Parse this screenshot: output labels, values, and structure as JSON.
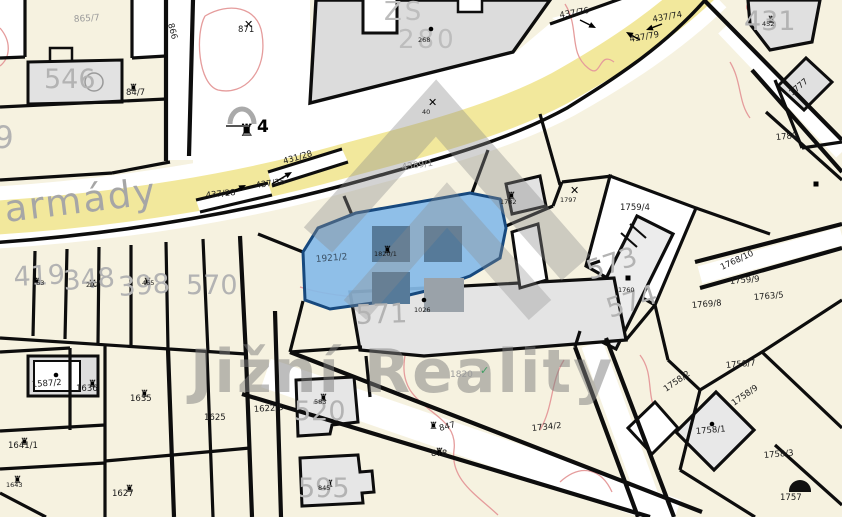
{
  "map": {
    "street": "armády",
    "watermark": "Jižní Reality",
    "school": {
      "abbr": "ZŠ",
      "number": "280"
    },
    "highlighted_parcel": {
      "number": "1921/2",
      "building_number": "1820/1",
      "fill": "#85bbe8",
      "border": "#17497e"
    },
    "colors": {
      "parcel_cream": "#f6f2e0",
      "road_yellow": "#f2e89c",
      "building_gray": "#dcdcdc",
      "highlight_blue": "#85bbe8",
      "highlight_building": "#567a99",
      "boundary_black": "#0d0d0d",
      "contour_red": "#e59c9c",
      "watermark_gray": "#7d7d7d"
    },
    "labels": [
      {
        "text": "865/7",
        "x": 74,
        "y": 22,
        "rot": -4,
        "cls": "sg"
      },
      {
        "text": "546",
        "x": 44,
        "y": 88,
        "rot": 0,
        "cls": "bg"
      },
      {
        "text": "84/7",
        "x": 126,
        "y": 95,
        "rot": 0,
        "cls": "sm"
      },
      {
        "text": "871",
        "x": 238,
        "y": 32,
        "rot": 0,
        "cls": "sm"
      },
      {
        "text": "866",
        "x": 168,
        "y": 24,
        "rot": 75,
        "cls": "sm"
      },
      {
        "text": "9",
        "x": -6,
        "y": 148,
        "rot": 0,
        "cls": "bg2"
      },
      {
        "text": "419",
        "x": 14,
        "y": 286,
        "rot": -3,
        "cls": "bg"
      },
      {
        "text": "348",
        "x": 64,
        "y": 290,
        "rot": -4,
        "cls": "bg"
      },
      {
        "text": "398",
        "x": 119,
        "y": 296,
        "rot": -4,
        "cls": "bg"
      },
      {
        "text": "570",
        "x": 186,
        "y": 294,
        "rot": 0,
        "cls": "bg"
      },
      {
        "text": "163",
        "x": 32,
        "y": 285,
        "rot": 0,
        "cls": "t6"
      },
      {
        "text": "292",
        "x": 86,
        "y": 287,
        "rot": 0,
        "cls": "t6"
      },
      {
        "text": "465",
        "x": 142,
        "y": 285,
        "rot": 0,
        "cls": "t6"
      },
      {
        "text": "268",
        "x": 418,
        "y": 42,
        "rot": 0,
        "cls": "t6"
      },
      {
        "text": "40",
        "x": 422,
        "y": 114,
        "rot": 0,
        "cls": "t6"
      },
      {
        "text": "4389/1",
        "x": 402,
        "y": 170,
        "rot": -8,
        "cls": "sg"
      },
      {
        "text": "431/28",
        "x": 284,
        "y": 164,
        "rot": -16,
        "cls": "sm"
      },
      {
        "text": "437/35",
        "x": 256,
        "y": 188,
        "rot": -8,
        "cls": "sm"
      },
      {
        "text": "437/28",
        "x": 206,
        "y": 198,
        "rot": -6,
        "cls": "sm"
      },
      {
        "text": "437/76",
        "x": 560,
        "y": 18,
        "rot": -10,
        "cls": "sm"
      },
      {
        "text": "437/74",
        "x": 653,
        "y": 22,
        "rot": -10,
        "cls": "sm"
      },
      {
        "text": "437/79",
        "x": 630,
        "y": 42,
        "rot": -10,
        "cls": "sm"
      },
      {
        "text": "431",
        "x": 744,
        "y": 30,
        "rot": 0,
        "cls": "bg"
      },
      {
        "text": "452",
        "x": 762,
        "y": 26,
        "rot": 0,
        "cls": "t6"
      },
      {
        "text": "1777",
        "x": 792,
        "y": 96,
        "rot": -40,
        "cls": "sm"
      },
      {
        "text": "1780",
        "x": 776,
        "y": 140,
        "rot": -5,
        "cls": "sm"
      },
      {
        "text": "571",
        "x": 356,
        "y": 324,
        "rot": -2,
        "cls": "bg"
      },
      {
        "text": "1026",
        "x": 414,
        "y": 312,
        "rot": 0,
        "cls": "t6"
      },
      {
        "text": "1782",
        "x": 500,
        "y": 204,
        "rot": 0,
        "cls": "t6"
      },
      {
        "text": "1797",
        "x": 560,
        "y": 202,
        "rot": 0,
        "cls": "t6"
      },
      {
        "text": "1759/4",
        "x": 620,
        "y": 210,
        "rot": 0,
        "cls": "sm"
      },
      {
        "text": "573",
        "x": 590,
        "y": 280,
        "rot": -18,
        "cls": "bg"
      },
      {
        "text": "574",
        "x": 610,
        "y": 318,
        "rot": -18,
        "cls": "bg"
      },
      {
        "text": "1760",
        "x": 618,
        "y": 292,
        "rot": 0,
        "cls": "t6"
      },
      {
        "text": "1768/10",
        "x": 722,
        "y": 270,
        "rot": -25,
        "cls": "sm"
      },
      {
        "text": "1759/9",
        "x": 730,
        "y": 284,
        "rot": -5,
        "cls": "sm"
      },
      {
        "text": "1763/5",
        "x": 754,
        "y": 300,
        "rot": -5,
        "cls": "sm"
      },
      {
        "text": "1769/8",
        "x": 692,
        "y": 308,
        "rot": -5,
        "cls": "sm"
      },
      {
        "text": "1758/7",
        "x": 726,
        "y": 368,
        "rot": -5,
        "cls": "sm"
      },
      {
        "text": "1758/2",
        "x": 666,
        "y": 392,
        "rot": -35,
        "cls": "sm"
      },
      {
        "text": "1758/9",
        "x": 734,
        "y": 406,
        "rot": -35,
        "cls": "sm"
      },
      {
        "text": "1758/1",
        "x": 696,
        "y": 434,
        "rot": -5,
        "cls": "sm"
      },
      {
        "text": "1758/3",
        "x": 764,
        "y": 458,
        "rot": -5,
        "cls": "sm"
      },
      {
        "text": "1757",
        "x": 780,
        "y": 500,
        "rot": 0,
        "cls": "sm"
      },
      {
        "text": "1820",
        "x": 450,
        "y": 377,
        "rot": 0,
        "cls": "sg"
      },
      {
        "text": "1734/2",
        "x": 532,
        "y": 431,
        "rot": -6,
        "cls": "sm"
      },
      {
        "text": "847",
        "x": 440,
        "y": 431,
        "rot": -15,
        "cls": "sm"
      },
      {
        "text": "878",
        "x": 431,
        "y": 456,
        "rot": 0,
        "cls": "sm"
      },
      {
        "text": "520",
        "x": 294,
        "y": 420,
        "rot": 0,
        "cls": "bg"
      },
      {
        "text": "583",
        "x": 314,
        "y": 404,
        "rot": 0,
        "cls": "t6"
      },
      {
        "text": "595",
        "x": 298,
        "y": 497,
        "rot": 0,
        "cls": "bg"
      },
      {
        "text": "845",
        "x": 318,
        "y": 490,
        "rot": 0,
        "cls": "t6"
      },
      {
        "text": "1587/2",
        "x": 32,
        "y": 387,
        "rot": -4,
        "cls": "sm"
      },
      {
        "text": "1636",
        "x": 76,
        "y": 391,
        "rot": 0,
        "cls": "sm"
      },
      {
        "text": "1635",
        "x": 130,
        "y": 401,
        "rot": 0,
        "cls": "sm"
      },
      {
        "text": "1625",
        "x": 204,
        "y": 420,
        "rot": 0,
        "cls": "sm"
      },
      {
        "text": "1641/1",
        "x": 8,
        "y": 448,
        "rot": 0,
        "cls": "sm"
      },
      {
        "text": "1627",
        "x": 112,
        "y": 496,
        "rot": 0,
        "cls": "sm"
      },
      {
        "text": "1622/5",
        "x": 254,
        "y": 412,
        "rot": -4,
        "cls": "sm"
      },
      {
        "text": "1643",
        "x": 6,
        "y": 487,
        "rot": 0,
        "cls": "t6"
      },
      {
        "text": "4",
        "x": 257,
        "y": 132,
        "rot": 0,
        "cls": "b4"
      }
    ],
    "symbols": [
      {
        "kind": "cross",
        "x": 244,
        "y": 20
      },
      {
        "kind": "cross",
        "x": 428,
        "y": 98
      },
      {
        "kind": "cross",
        "x": 570,
        "y": 186
      },
      {
        "kind": "bldg",
        "x": 134,
        "y": 82
      },
      {
        "kind": "bldg",
        "x": 37,
        "y": 276
      },
      {
        "kind": "bldg",
        "x": 93,
        "y": 278
      },
      {
        "kind": "bldg",
        "x": 148,
        "y": 276
      },
      {
        "kind": "bldg",
        "x": 324,
        "y": 392
      },
      {
        "kind": "bldg",
        "x": 330,
        "y": 478
      },
      {
        "kind": "bldg",
        "x": 434,
        "y": 420
      },
      {
        "kind": "bldg",
        "x": 440,
        "y": 446
      },
      {
        "kind": "bldg",
        "x": 512,
        "y": 190
      },
      {
        "kind": "bldg",
        "x": 93,
        "y": 378
      },
      {
        "kind": "bldg",
        "x": 145,
        "y": 388
      },
      {
        "kind": "bldg",
        "x": 25,
        "y": 436
      },
      {
        "kind": "bldg",
        "x": 130,
        "y": 483
      },
      {
        "kind": "bldg",
        "x": 18,
        "y": 474
      },
      {
        "kind": "bldg",
        "x": 388,
        "y": 244
      },
      {
        "kind": "bldg",
        "x": 772,
        "y": 14
      },
      {
        "kind": "bldg-lg",
        "x": 247,
        "y": 124
      },
      {
        "kind": "dot",
        "x": 431,
        "y": 29
      },
      {
        "kind": "dot",
        "x": 424,
        "y": 300
      },
      {
        "kind": "dot",
        "x": 712,
        "y": 424
      },
      {
        "kind": "dot",
        "x": 56,
        "y": 375
      },
      {
        "kind": "sq",
        "x": 628,
        "y": 278
      },
      {
        "kind": "sq",
        "x": 816,
        "y": 184
      },
      {
        "kind": "dome",
        "x": 800,
        "y": 491
      },
      {
        "kind": "check",
        "x": 480,
        "y": 374
      },
      {
        "kind": "arch",
        "x": 242,
        "y": 96
      }
    ],
    "arrows": [
      {
        "x1": 272,
        "y1": 184,
        "x2": 292,
        "y2": 172
      },
      {
        "x1": 226,
        "y1": 195,
        "x2": 246,
        "y2": 185
      },
      {
        "x1": 580,
        "y1": 20,
        "x2": 596,
        "y2": 28
      },
      {
        "x1": 662,
        "y1": 24,
        "x2": 646,
        "y2": 30
      },
      {
        "x1": 640,
        "y1": 40,
        "x2": 626,
        "y2": 32
      }
    ]
  }
}
